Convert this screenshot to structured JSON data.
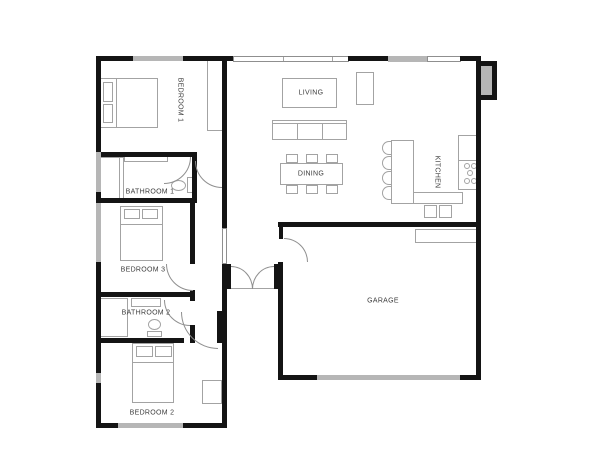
{
  "plan": {
    "rooms": {
      "bedroom1": {
        "label": "BEDROOM 1"
      },
      "bathroom1": {
        "label": "BATHROOM 1"
      },
      "bedroom3": {
        "label": "BEDROOM 3"
      },
      "bathroom2": {
        "label": "BATHROOM 2"
      },
      "bedroom2": {
        "label": "BEDROOM 2"
      },
      "living": {
        "label": "LIVING"
      },
      "dining": {
        "label": "DINING"
      },
      "kitchen": {
        "label": "KITCHEN"
      },
      "garage": {
        "label": "GARAGE"
      }
    },
    "colors": {
      "wall": "#141414",
      "window": "#b6b6b6",
      "furniture_outline": "#a3a3a3",
      "label_text": "#3d3d3d",
      "background": "#ffffff"
    }
  }
}
